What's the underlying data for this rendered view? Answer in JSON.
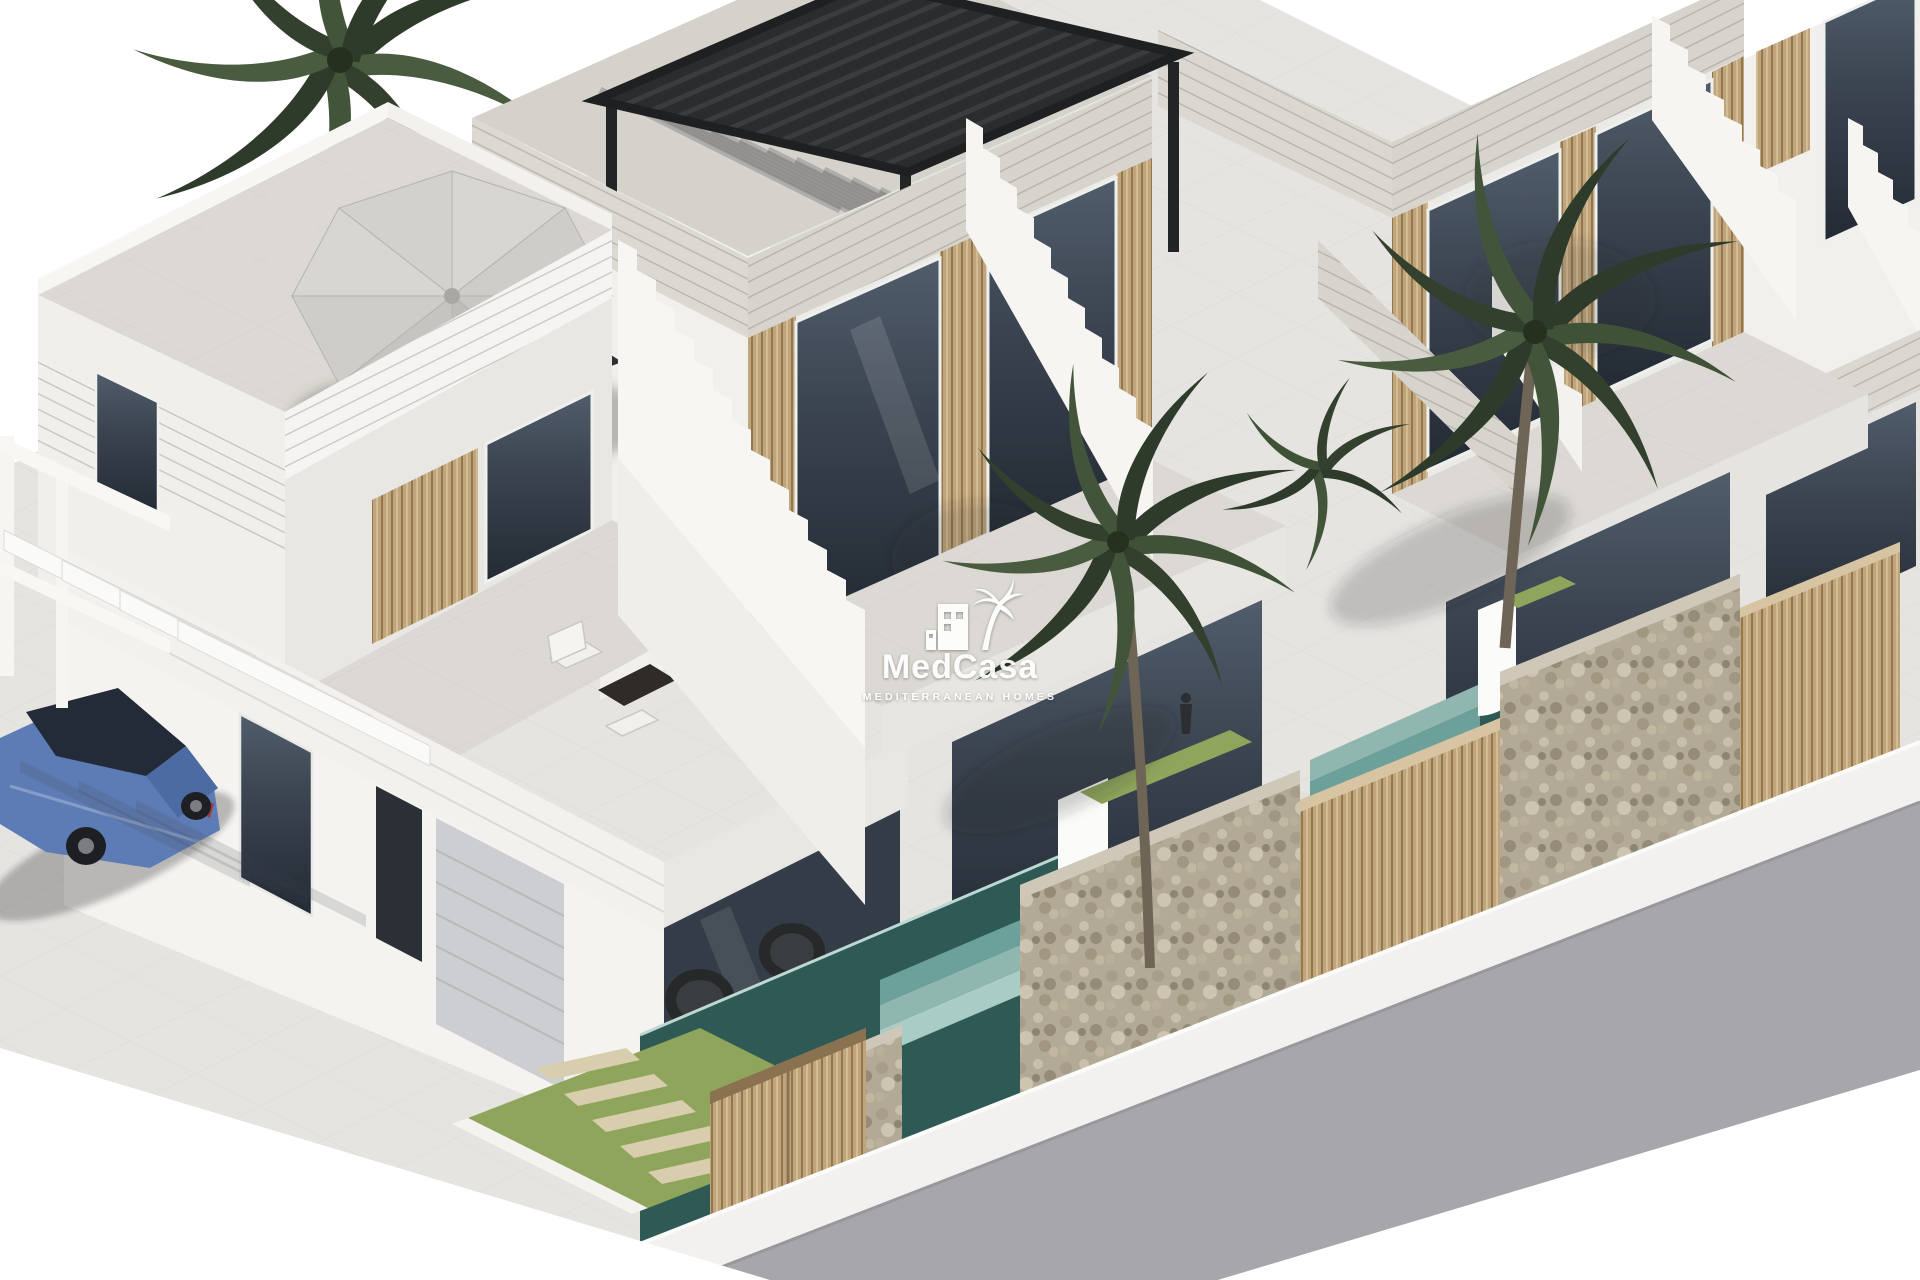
{
  "watermark": {
    "brand": "MedCasa",
    "tagline": "MEDITERRANEAN HOMES",
    "icon": "building-with-palm-icon"
  },
  "scene": {
    "type": "architectural-3d-render",
    "subject": "Row of modern white two-storey villas with roof terraces, palm trees, plunge pools, stone walls and street",
    "villas_visible": 4,
    "palm_trees_visible": 3,
    "parked_cars": 1
  },
  "colors": {
    "background": "#ffffff",
    "pavement": "#e6e4e1",
    "road": "#a7a7ab",
    "sidewalk": "#f2f1ef",
    "wall_lit": "#f5f4f1",
    "wall_shaded": "#e9e7e3",
    "stone_band": "#d9d6d0",
    "roof_floor": "#dcd9d4",
    "glass_dark": "#39424e",
    "wood_slats": "#c0a47c",
    "gate_wood": "#b3976f",
    "gabion_stone": "#b3a997",
    "grass": "#8fa55b",
    "stepping_stone": "#d8cead",
    "pool_deep": "#2f5955",
    "pool_steps": "#8fb7b0",
    "palm_dark": "#2e3b2b",
    "palm_mid": "#3f5136",
    "palm_light": "#55674a",
    "pergola_black": "#2b2c2e",
    "umbrella": "#cbc9c5",
    "car_blue": "#5d7cb6",
    "car_glass": "#232b38",
    "watermark_white": "#ffffff"
  }
}
